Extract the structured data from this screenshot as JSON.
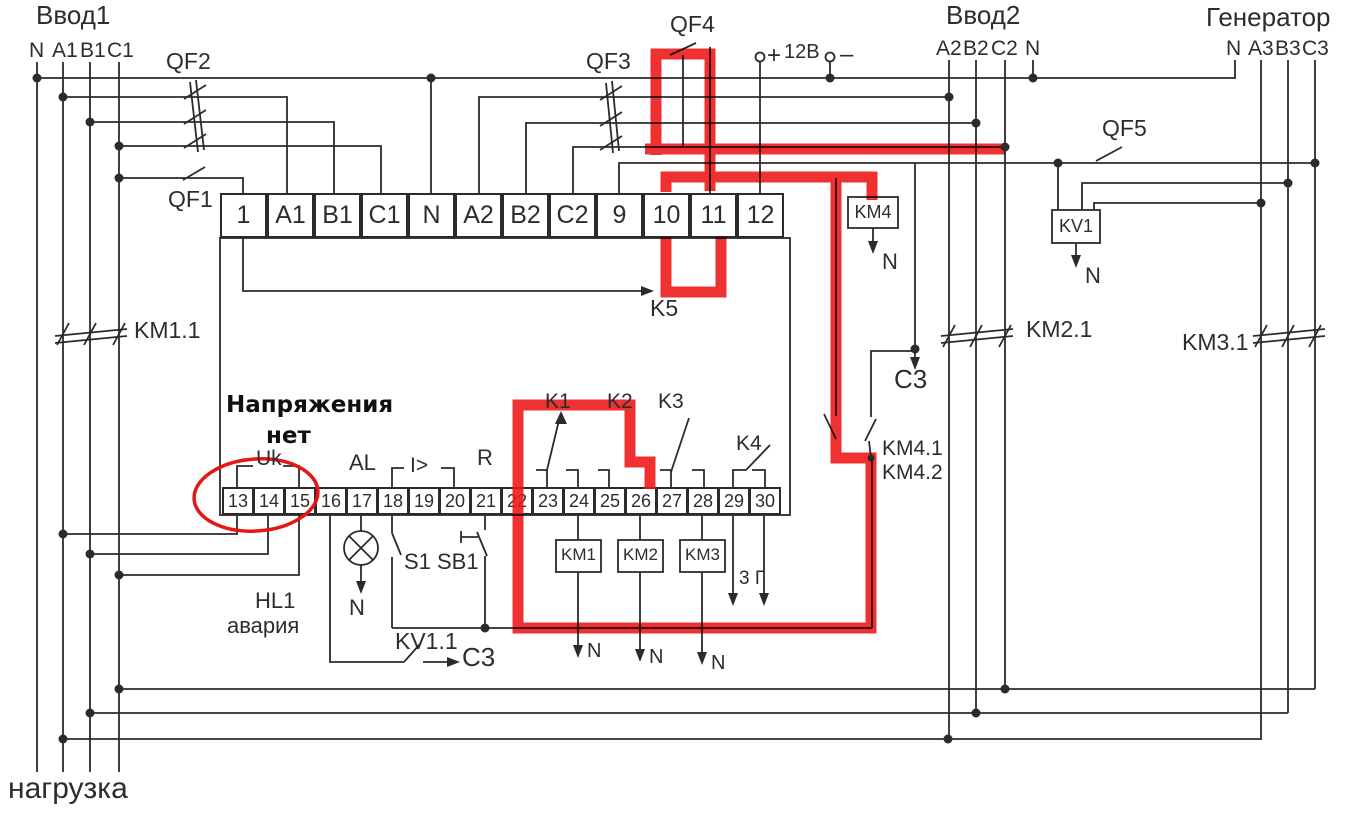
{
  "colors": {
    "highlight": "#ee1414",
    "line": "#2b2b2b"
  },
  "titles": {
    "input1": "Ввод1",
    "input2": "Ввод2",
    "generator": "Генератор",
    "load": "нагрузка"
  },
  "feeders": {
    "input1_lines": [
      "N",
      "A1",
      "B1",
      "C1"
    ],
    "input2_lines": [
      "A2",
      "B2",
      "C2",
      "N"
    ],
    "generator_lines": [
      "N",
      "A3",
      "B3",
      "C3"
    ]
  },
  "breakers": {
    "qf1": "QF1",
    "qf2": "QF2",
    "qf3": "QF3",
    "qf4": "QF4",
    "qf5": "QF5"
  },
  "power12v": {
    "plus": "+",
    "volts": "12В",
    "minus": "–"
  },
  "contactors": {
    "km1": "KM1",
    "km2": "KM2",
    "km3": "KM3",
    "km4": "KM4",
    "km1_1": "KM1.1",
    "km2_1": "KM2.1",
    "km3_1": "KM3.1",
    "km4_1": "KM4.1",
    "km4_2": "KM4.2"
  },
  "relays": {
    "k1": "K1",
    "k2": "K2",
    "k3": "K3",
    "k4": "K4",
    "k5": "K5",
    "kv1": "KV1",
    "kv1_1": "KV1.1"
  },
  "terminals": {
    "top": [
      "1",
      "A1",
      "B1",
      "C1",
      "N",
      "A2",
      "B2",
      "C2",
      "9",
      "10",
      "11",
      "12"
    ],
    "bottom": [
      "13",
      "14",
      "15",
      "16",
      "17",
      "18",
      "19",
      "20",
      "21",
      "22",
      "23",
      "24",
      "25",
      "26",
      "27",
      "28",
      "29",
      "30"
    ]
  },
  "annotations": {
    "no_voltage_line1": "Напряжения",
    "no_voltage_line2": "нет",
    "uk": "Uk",
    "al": "AL",
    "overcurrent": "I>",
    "reset": "R",
    "hl1": "HL1",
    "alarm": "авария",
    "s1": "S1",
    "sb1": "SB1",
    "c3": "C3",
    "n": "N",
    "out_29_30": "3 Г"
  }
}
